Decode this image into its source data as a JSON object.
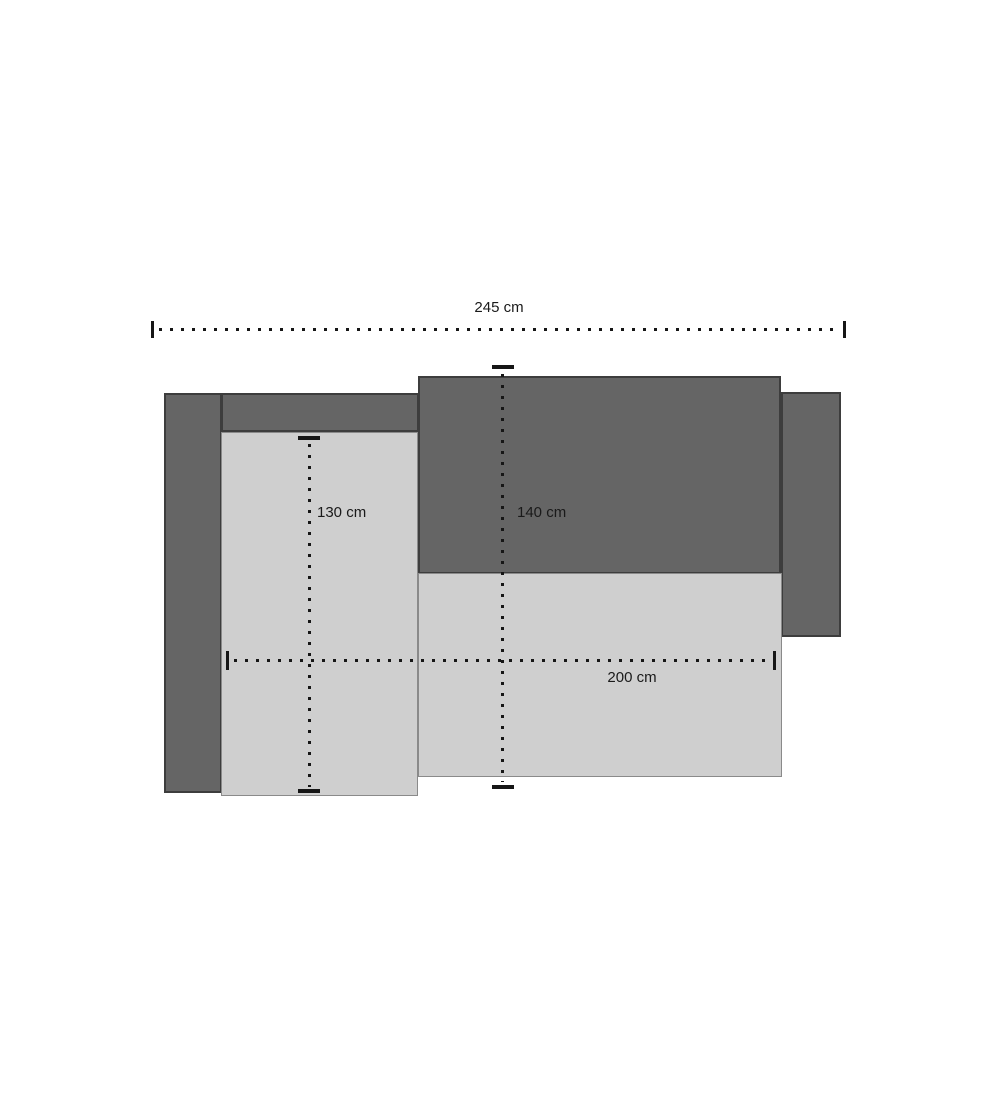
{
  "diagram": {
    "type": "furniture-dimension-plan",
    "unit": "cm",
    "dimensions": {
      "total_width": {
        "label": "245 cm",
        "value": 245
      },
      "chaise_depth": {
        "label": "130 cm",
        "value": 130
      },
      "sofa_depth": {
        "label": "140 cm",
        "value": 140
      },
      "seat_width": {
        "label": "200 cm",
        "value": 200
      }
    },
    "colors": {
      "dark_fill": "#656565",
      "dark_border": "#3d3d3d",
      "light_fill": "#cfcfcf",
      "light_border": "#8a8a8a",
      "line_color": "#161616",
      "text_color": "#1a1a1a",
      "background": "#ffffff"
    }
  }
}
